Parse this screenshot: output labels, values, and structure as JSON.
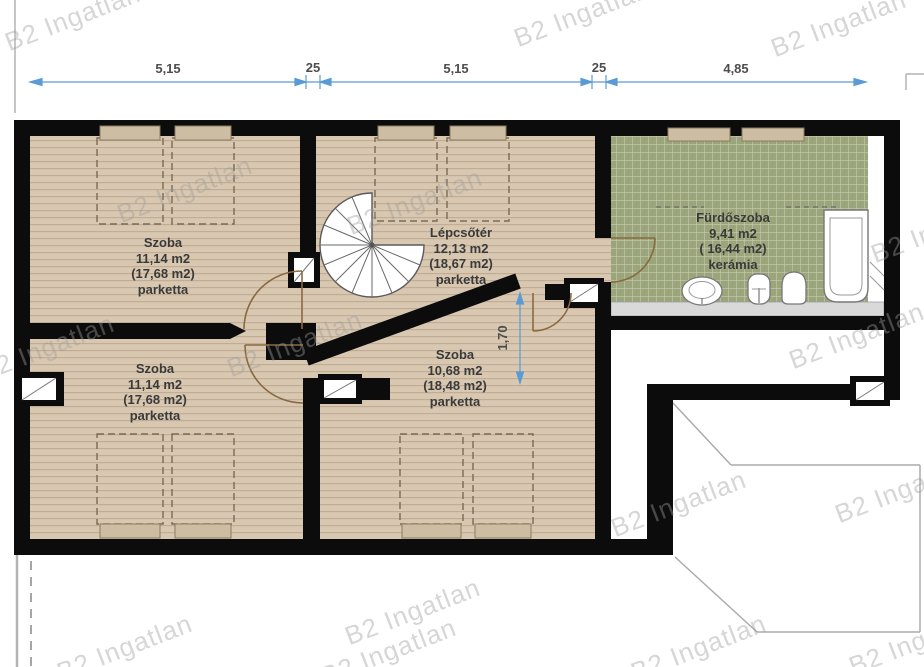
{
  "title": "Emeleti alaprajz (floor plan)",
  "watermark": {
    "text": "B2 Ingatlan"
  },
  "dimensions": {
    "top": [
      "5,15",
      "25",
      "5,15",
      "25",
      "4,85"
    ],
    "vertical": "1,70",
    "color": "#5b9bd5"
  },
  "rooms": {
    "szoba_top_left": {
      "name": "Szoba",
      "area": "11,14 m2",
      "gross": "(17,68 m2)",
      "floor": "parketta"
    },
    "lepcsoter": {
      "name": "Lépcsőtér",
      "area": "12,13 m2",
      "gross": "(18,67 m2)",
      "floor": "parketta"
    },
    "furdoszoba": {
      "name": "Fürdőszoba",
      "area": "9,41 m2",
      "gross": "( 16,44 m2)",
      "floor": "kerámia"
    },
    "szoba_bottom_left": {
      "name": "Szoba",
      "area": "11,14 m2",
      "gross": "(17,68 m2)",
      "floor": "parketta"
    },
    "szoba_bottom_center": {
      "name": "Szoba",
      "area": "10,68 m2",
      "gross": "(18,48 m2)",
      "floor": "parketta"
    }
  },
  "fixtures": [
    "spiral-staircase",
    "washbasin",
    "bidet",
    "toilet",
    "bathtub",
    "beds"
  ],
  "colors": {
    "wall": "#0c0c0c",
    "parquet": "#d8c8b2",
    "parquet_stripe": "#c2ad93",
    "tile": "#9aa57b",
    "tile_grid": "#c8ccb0",
    "furniture_outline": "#7a6a50",
    "headboard_fill": "#cdbda2",
    "door_arc": "#8a6a40",
    "dimension_blue": "#5b9bd5"
  }
}
